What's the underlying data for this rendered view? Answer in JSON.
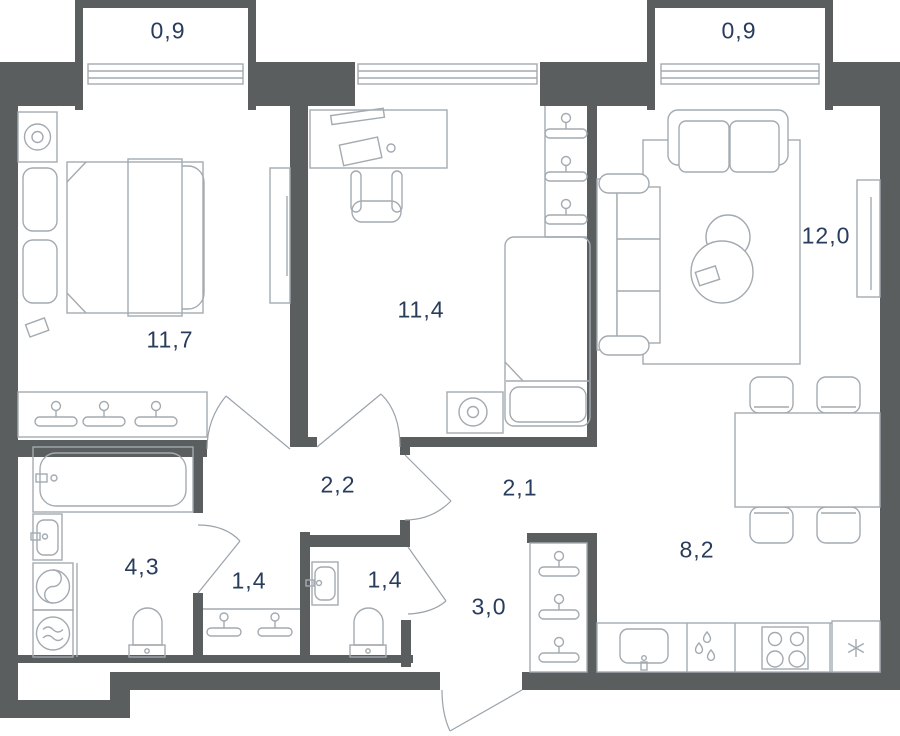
{
  "colors": {
    "wall": "#5a5e5e",
    "furniture_line": "#a3aab1",
    "label_text": "#283c5c",
    "background": "#ffffff"
  },
  "rooms": [
    {
      "name": "balcony-left",
      "label": "0,9"
    },
    {
      "name": "balcony-right",
      "label": "0,9"
    },
    {
      "name": "bedroom",
      "label": "11,7"
    },
    {
      "name": "room",
      "label": "11,4"
    },
    {
      "name": "living-room",
      "label": "12,0"
    },
    {
      "name": "hall",
      "label": "2,2"
    },
    {
      "name": "corridor",
      "label": "2,1"
    },
    {
      "name": "bathroom",
      "label": "4,3"
    },
    {
      "name": "storage",
      "label": "1,4"
    },
    {
      "name": "wc",
      "label": "1,4"
    },
    {
      "name": "entry-hall",
      "label": "3,0"
    },
    {
      "name": "kitchen",
      "label": "8,2"
    }
  ],
  "icons": {
    "hanger": "coat-hanger",
    "fridge": "snowflake-asterisk",
    "dishwasher": "water-drops",
    "stove": "four-burners",
    "washing-machine": "drum-with-s-curve",
    "dryer": "drum-with-waves",
    "lamp": "concentric-circles"
  }
}
